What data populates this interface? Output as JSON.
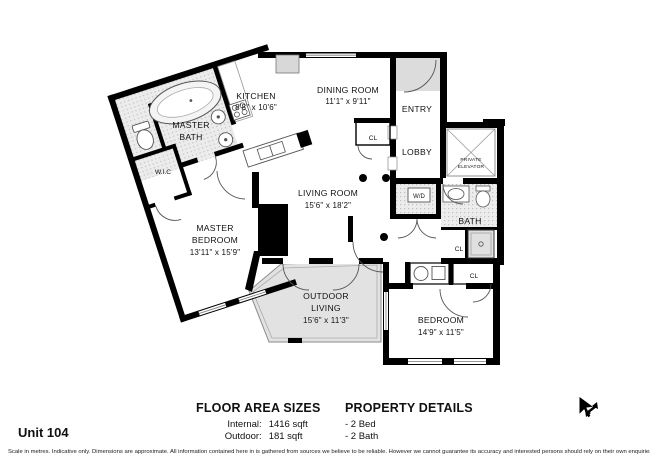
{
  "unit": {
    "label": "Unit 104"
  },
  "rooms": {
    "kitchen": {
      "name": "KITCHEN",
      "dims": "8'8\" x 10'6\""
    },
    "dining": {
      "name": "DINING ROOM",
      "dims": "11'1\" x 9'11\""
    },
    "entry": {
      "name": "ENTRY"
    },
    "lobby": {
      "name": "LOBBY"
    },
    "elevator": {
      "line1": "PRIVATE",
      "line2": "ELEVATOR"
    },
    "closet_dining": {
      "label": "CL"
    },
    "living": {
      "name": "LIVING ROOM",
      "dims": "15'6\" x 18'2\""
    },
    "laundry": {
      "label": "W/D"
    },
    "bath": {
      "name": "BATH"
    },
    "closet_hall": {
      "label": "CL"
    },
    "closet_bedroom": {
      "label": "CL"
    },
    "master_bath": {
      "line1": "MASTER",
      "line2": "BATH"
    },
    "wic": {
      "name": "W.I.C"
    },
    "master_bedroom": {
      "line1": "MASTER",
      "line2": "BEDROOM",
      "dims": "13'11\" x 15'9\""
    },
    "outdoor": {
      "line1": "OUTDOOR",
      "line2": "LIVING",
      "dims": "15'6\" x 11'3\""
    },
    "bedroom": {
      "name": "BEDROOM",
      "dims": "14'9\" x 11'5\""
    }
  },
  "floor_area": {
    "title": "FLOOR AREA SIZES",
    "rows": [
      {
        "label": "Internal:",
        "value": "1416 sqft"
      },
      {
        "label": "Outdoor:",
        "value": "181 sqft"
      }
    ]
  },
  "property": {
    "title": "PROPERTY DETAILS",
    "items": [
      "- 2 Bed",
      "- 2 Bath"
    ]
  },
  "disclaimer": "Scale in metres. Indicative only. Dimensions are approximate. All information contained here in is gathered from sources we believe to be reliable. However we cannot guarantee its accuracy and interested persons should rely on their own enquiries.",
  "colors": {
    "wall": "#000000",
    "bath_tile": "#e9e9e9",
    "outdoor_fill": "#e2e2e2",
    "vestibule_fill": "#dcdcdc"
  }
}
